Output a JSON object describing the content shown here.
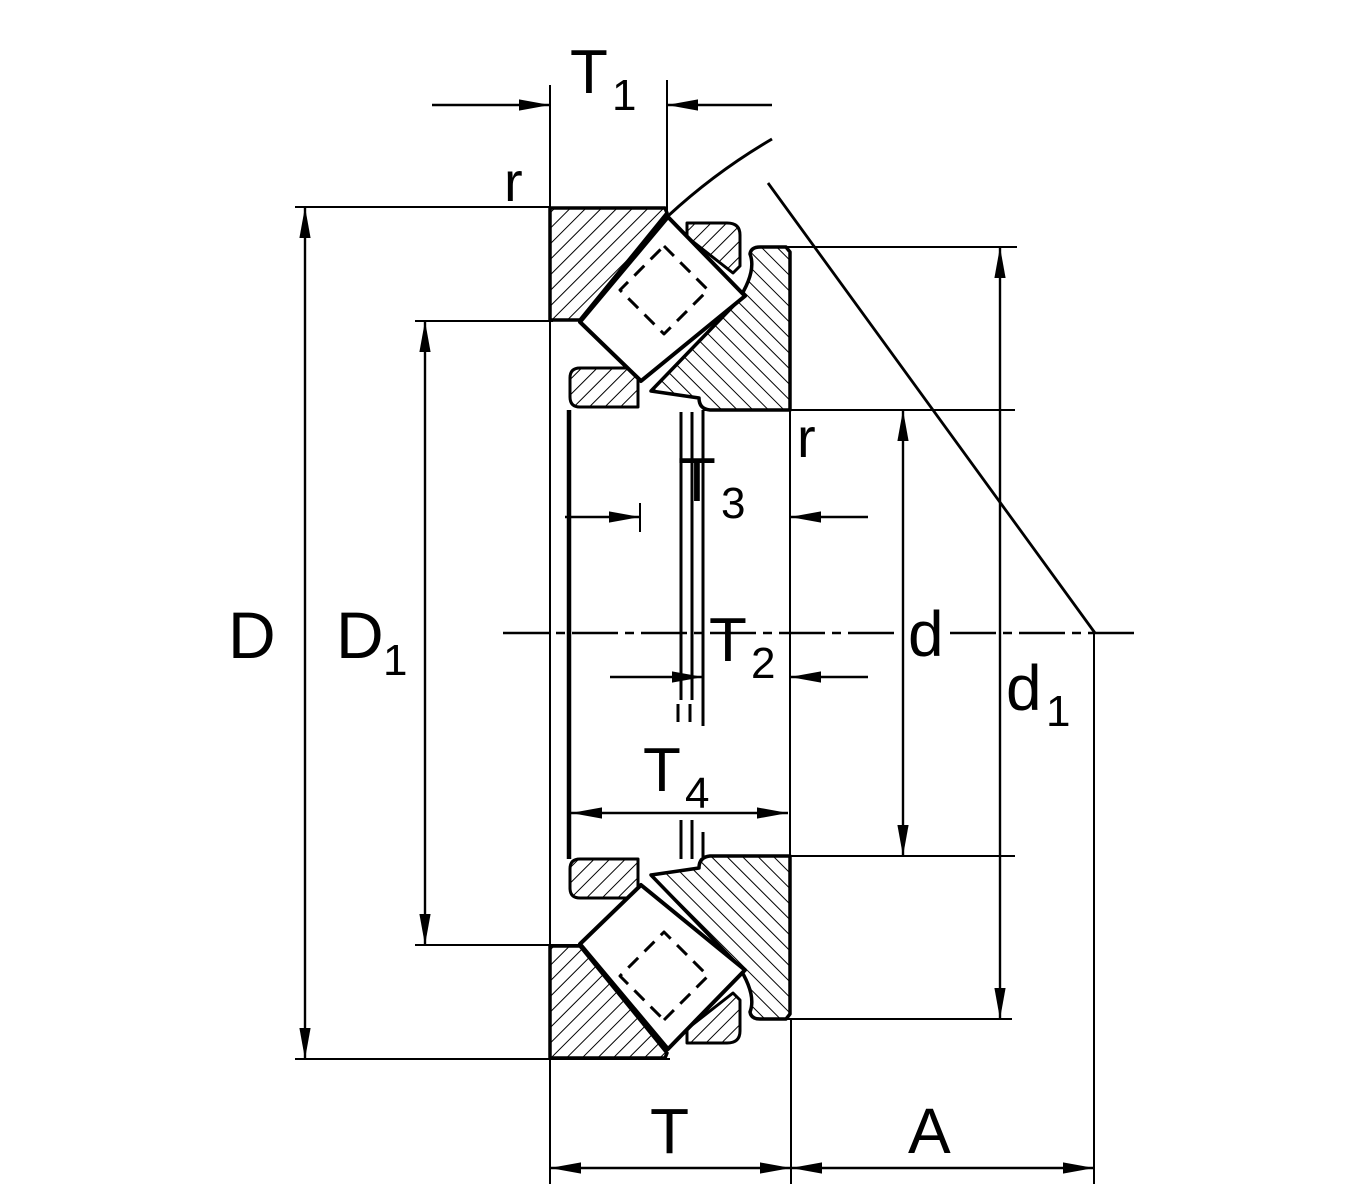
{
  "drawing": {
    "description": "Spherical roller thrust bearing cross-section dimension drawing",
    "colors": {
      "ink": "#000000",
      "paper": "#ffffff"
    },
    "labels": {
      "t1": {
        "main": "T",
        "sub": "1"
      },
      "r_top": {
        "main": "r",
        "sub": ""
      },
      "r_inner": {
        "main": "r",
        "sub": ""
      },
      "t3": {
        "main": "T",
        "sub": "3"
      },
      "t2": {
        "main": "T",
        "sub": "2"
      },
      "t4": {
        "main": "T",
        "sub": "4"
      },
      "D": {
        "main": "D",
        "sub": ""
      },
      "D1": {
        "main": "D",
        "sub": "1"
      },
      "d": {
        "main": "d",
        "sub": ""
      },
      "d1": {
        "main": "d",
        "sub": "1"
      },
      "T": {
        "main": "T",
        "sub": ""
      },
      "A": {
        "main": "A",
        "sub": ""
      }
    }
  }
}
